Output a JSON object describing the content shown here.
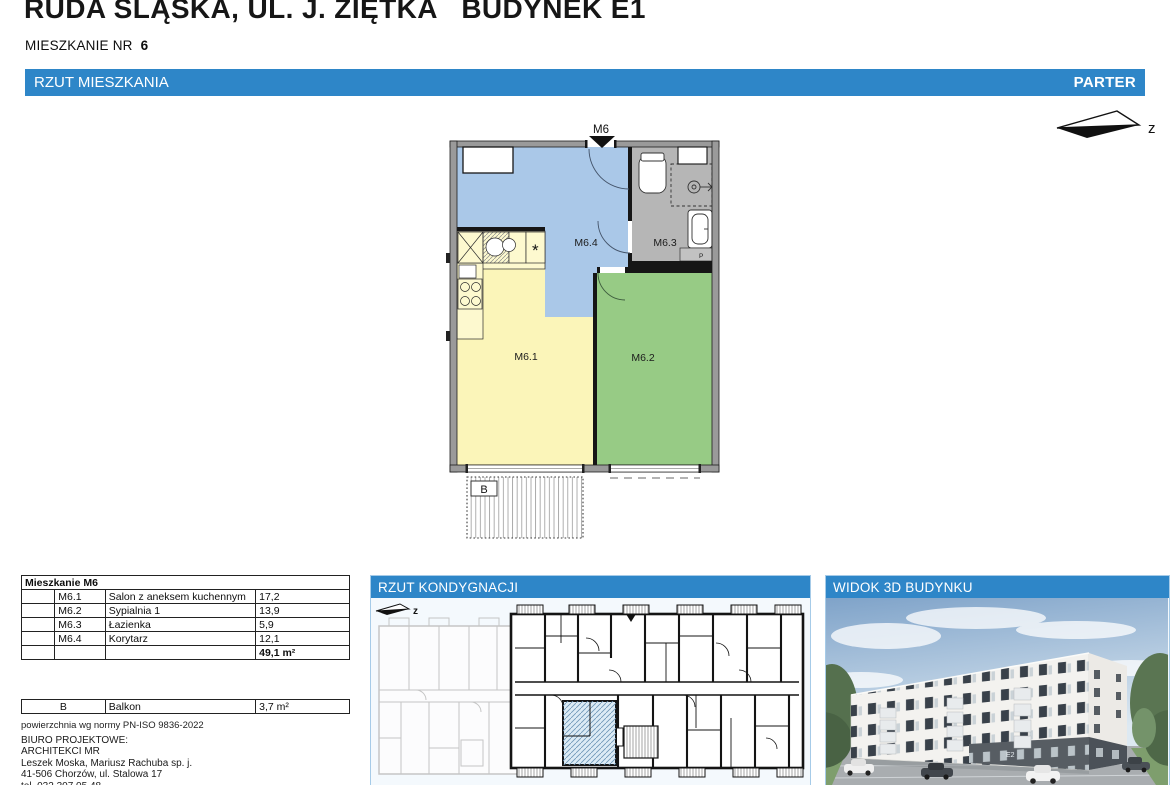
{
  "header": {
    "title": "RUDA ŚLĄSKA, UL. J. ZIĘTKA   BUDYNEK E1",
    "apartment_label": "MIESZKANIE NR",
    "apartment_number": "6"
  },
  "section_bar": {
    "title": "RZUT MIESZKANIA",
    "floor": "PARTER"
  },
  "compass": {
    "direction": "z"
  },
  "floor_plan": {
    "entrance_label": "M6",
    "rooms": [
      {
        "id": "M6.1"
      },
      {
        "id": "M6.2"
      },
      {
        "id": "M6.3"
      },
      {
        "id": "M6.4"
      }
    ],
    "balcony_label": "B",
    "washing_machine_label": "P",
    "kitchen_symbol": "*"
  },
  "area_table": {
    "title": "Mieszkanie M6",
    "rows": [
      {
        "code": "M6.1",
        "name": "Salon z aneksem kuchennym",
        "area": "17,2"
      },
      {
        "code": "M6.2",
        "name": "Sypialnia 1",
        "area": "13,9"
      },
      {
        "code": "M6.3",
        "name": "Łazienka",
        "area": "5,9"
      },
      {
        "code": "M6.4",
        "name": "Korytarz",
        "area": "12,1"
      }
    ],
    "total_area": "49,1 m²"
  },
  "balcony_table": {
    "code": "B",
    "name": "Balkon",
    "area": "3,7 m²"
  },
  "footnote": "powierzchnia wg normy PN-ISO 9836-2022",
  "design_office": {
    "lines": [
      "BIURO PROJEKTOWE:",
      "ARCHITEKCI MR",
      "Leszek Moska, Mariusz Rachuba sp. j.",
      "41-506 Chorzów, ul. Stalowa 17",
      "tel. 032 307 05 48."
    ]
  },
  "floor_panel": {
    "title": "RZUT KONDYGNACJI",
    "compass": "z"
  },
  "view3d_panel": {
    "title": "WIDOK 3D BUDYNKU",
    "entrance_sign": "E2"
  },
  "colors": {
    "accent_blue": "#2e86c8",
    "room_hall": "#aac8e8",
    "room_living": "#fbf5b9",
    "room_bedroom": "#97cb85",
    "room_bath": "#b6b6b6"
  }
}
